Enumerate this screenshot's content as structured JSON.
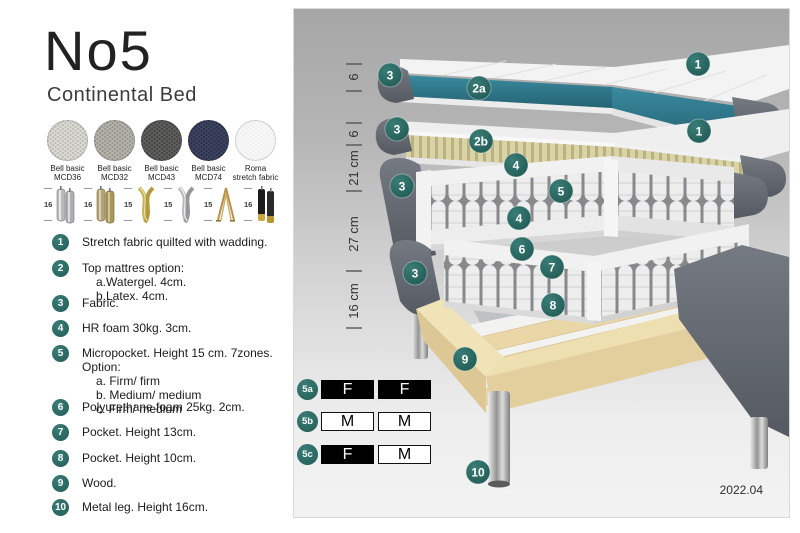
{
  "header": {
    "title": "No5",
    "subtitle": "Continental Bed"
  },
  "fabrics": [
    {
      "line1": "Bell basic",
      "line2": "MCD36",
      "color": "#d9d8d2",
      "dot": "#b4b3ac"
    },
    {
      "line1": "Bell basic",
      "line2": "MCD32",
      "color": "#b3b2aa",
      "dot": "#8e8d85"
    },
    {
      "line1": "Bell basic",
      "line2": "MCD43",
      "color": "#5d5e5c",
      "dot": "#3d3e3d"
    },
    {
      "line1": "Bell basic",
      "line2": "MCD74",
      "color": "#3d4260",
      "dot": "#252a44"
    },
    {
      "line1": "Roma",
      "line2": "stretch fabric",
      "color": "#f7f7f7",
      "dot": "#ededed"
    }
  ],
  "legs": [
    {
      "height": "16",
      "style": "cylinder-silver"
    },
    {
      "height": "16",
      "style": "cylinder-bronze"
    },
    {
      "height": "15",
      "style": "twist-gold"
    },
    {
      "height": "15",
      "style": "twist-silver"
    },
    {
      "height": "15",
      "style": "hairpin-gold"
    },
    {
      "height": "16",
      "style": "cylinder-black-gold"
    }
  ],
  "legend": [
    {
      "num": "1",
      "text": "Stretch fabric quilted with wadding."
    },
    {
      "num": "2",
      "text": "Top mattres option:",
      "sub": [
        "a.Watergel. 4cm.",
        "b.Latex. 4cm."
      ]
    },
    {
      "num": "3",
      "text": "Fabric."
    },
    {
      "num": "4",
      "text": "HR foam 30kg. 3cm."
    },
    {
      "num": "5",
      "text": "Micropocket. Height 15 cm. 7zones. Option:",
      "sub": [
        "a. Firm/ firm",
        "b. Medium/ medium",
        "c. Firm/ medium"
      ]
    },
    {
      "num": "6",
      "text": "Polyurethane foam 25kg. 2cm."
    },
    {
      "num": "7",
      "text": "Pocket. Height 13cm."
    },
    {
      "num": "8",
      "text": "Pocket. Height 10cm."
    },
    {
      "num": "9",
      "text": "Wood."
    },
    {
      "num": "10",
      "text": "Metal leg. Height 16cm."
    }
  ],
  "diagram": {
    "measurements": [
      "6",
      "6",
      "21 cm",
      "27 cm",
      "16 cm"
    ],
    "callouts": [
      "1",
      "2a",
      "3",
      "3",
      "1",
      "2b",
      "4",
      "5",
      "3",
      "4",
      "6",
      "7",
      "3",
      "8",
      "9",
      "10"
    ],
    "firmness_table": [
      {
        "label": "5a",
        "cells": [
          {
            "value": "F",
            "style": "firm"
          },
          {
            "value": "F",
            "style": "firm"
          }
        ]
      },
      {
        "label": "5b",
        "cells": [
          {
            "value": "M",
            "style": "medium"
          },
          {
            "value": "M",
            "style": "medium"
          }
        ]
      },
      {
        "label": "5c",
        "cells": [
          {
            "value": "F",
            "style": "firm"
          },
          {
            "value": "M",
            "style": "medium"
          }
        ]
      }
    ],
    "revision": "2022.04",
    "accent_teal": "#2c6e68",
    "watergel_teal": "#2f7e92"
  }
}
